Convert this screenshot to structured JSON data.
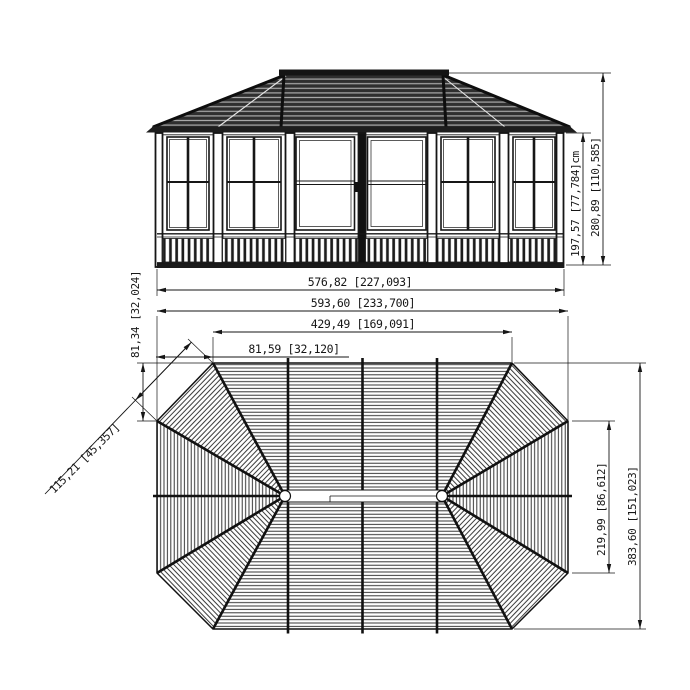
{
  "drawing": {
    "elevation": {
      "name": "front elevation view",
      "dim_wall_height": "197,57 [77,784]cm",
      "dim_total_height": "280,89 [110,585]",
      "dim_width": "576,82 [227,093]"
    },
    "plan": {
      "name": "roof plan view",
      "dim_overall_width": "593,60 [233,700]",
      "dim_ridge_width": "429,49 [169,091]",
      "dim_corner_width": "81,59 [32,120]",
      "dim_corner_height": "81,34 [32,024]",
      "dim_corner_diagonal": "115,21 [45,357]",
      "dim_side_length": "219,99 [86,612]",
      "dim_overall_height": "383,60 [151,023]"
    },
    "colors": {
      "line": "#1a1a1a",
      "roof_fill": "#2f2f2f",
      "roof_stripe": "#ababab",
      "background": "#ffffff"
    }
  }
}
